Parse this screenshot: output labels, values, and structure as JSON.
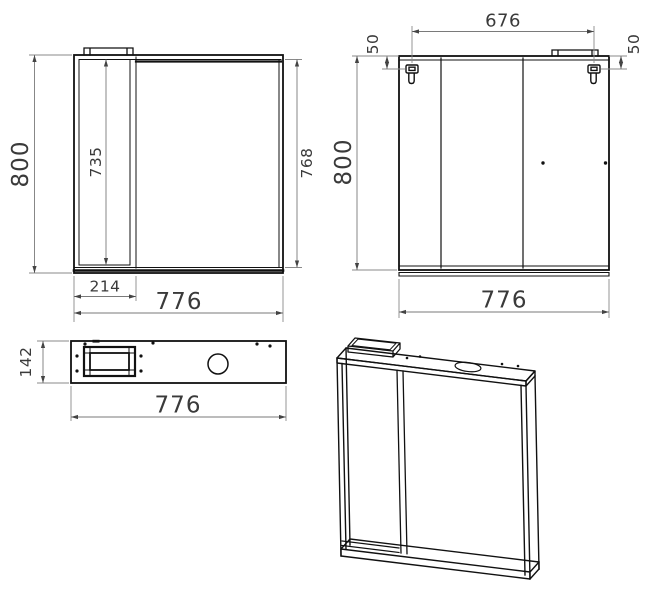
{
  "colors": {
    "outline": "#111111",
    "dimension_line": "#8a8a8a",
    "dimension_text": "#3a3a3a",
    "background": "#ffffff"
  },
  "views": {
    "front": {
      "overall_height": "800",
      "compartment_height": "735",
      "mirror_height": "768",
      "compartment_width": "214",
      "overall_width": "776"
    },
    "rear": {
      "hanger_spacing": "676",
      "hanger_offset_left": "50",
      "hanger_offset_right": "50",
      "overall_height": "800",
      "overall_width": "776"
    },
    "top": {
      "depth": "142",
      "overall_width": "776"
    }
  }
}
